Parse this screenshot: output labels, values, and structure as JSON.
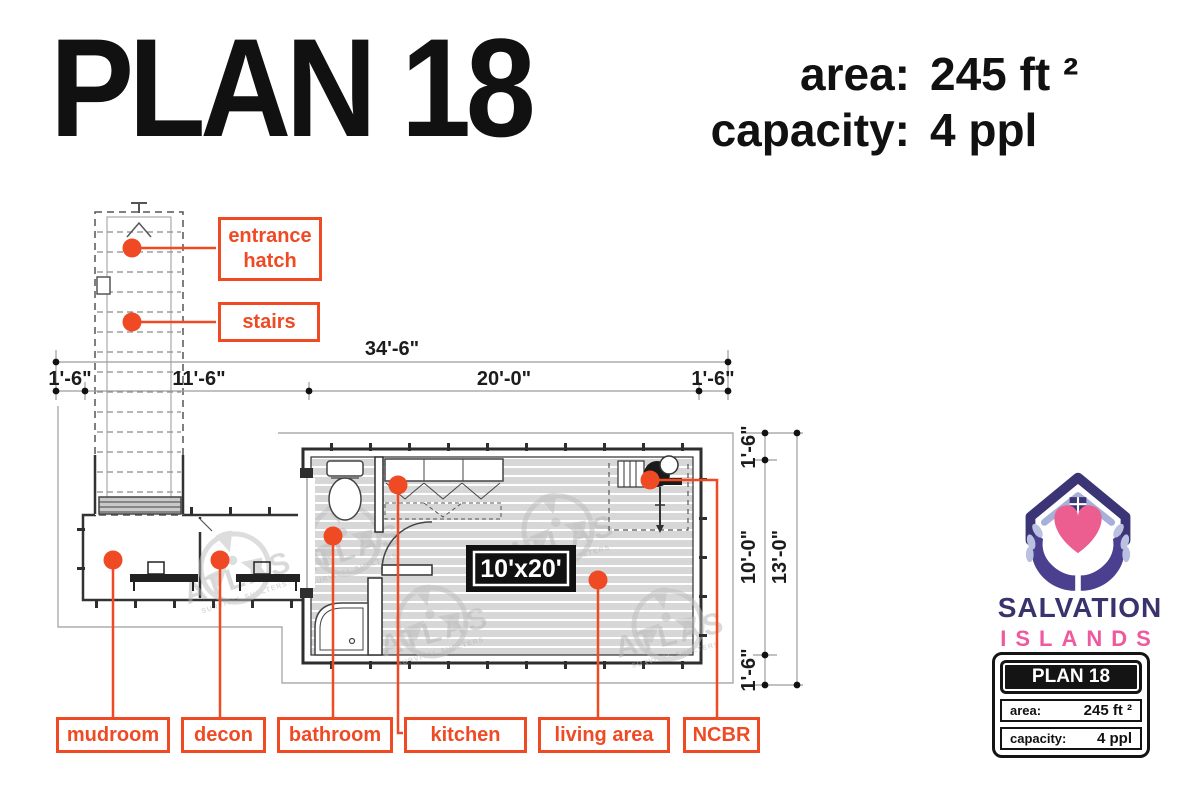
{
  "header": {
    "title": "PLAN 18",
    "specs": [
      {
        "label": "area:",
        "value": "245 ft ²"
      },
      {
        "label": "capacity:",
        "value": "4 ppl"
      }
    ]
  },
  "plan": {
    "callouts": {
      "entrance_hatch": "entrance hatch",
      "stairs": "stairs"
    },
    "rooms": [
      "mudroom",
      "decon",
      "bathroom",
      "kitchen",
      "living area",
      "NCBR"
    ],
    "dims": {
      "total_width": "34'-6\"",
      "left_margin": "1'-6\"",
      "stair_bay": "11'-6\"",
      "container_w": "20'-0\"",
      "right_margin": "1'-6\"",
      "top_margin": "1'-6\"",
      "container_d": "10'-0\"",
      "bottom_margin": "1'-6\"",
      "total_depth": "13'-0\""
    },
    "size_tag": "10'x20'",
    "watermark": {
      "name": "ATLAS",
      "tagline": "SURVIVAL SHELTERS"
    }
  },
  "logo": {
    "line1": "SALVATION",
    "line2": "ISLANDS",
    "card": {
      "title": "PLAN 18",
      "rows": [
        {
          "label": "area:",
          "value": "245 ft ²"
        },
        {
          "label": "capacity:",
          "value": "4 ppl"
        }
      ]
    }
  },
  "colors": {
    "accent": "#f04a25",
    "indigo": "#38336d",
    "pink": "#ef5a9e",
    "floor_gray": "#d7d7d7"
  }
}
